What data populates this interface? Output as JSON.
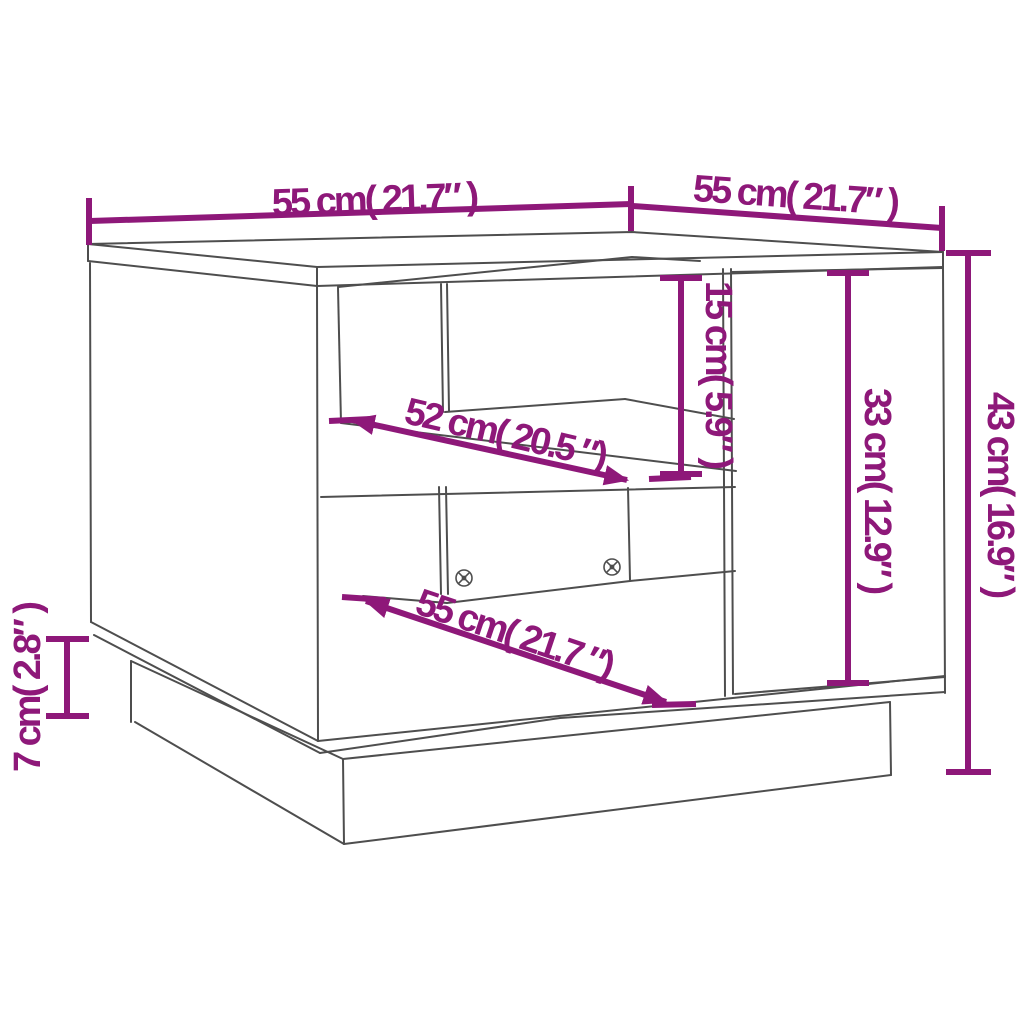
{
  "diagram": {
    "kind": "furniture-dimension-line-drawing",
    "subject": "coffee-table-with-shelves-and-base",
    "background": "#ffffff"
  },
  "colors": {
    "dimension": "#8E1879",
    "line": "#4e4e4e"
  },
  "dimensions": {
    "top_width": {
      "cm": 55,
      "inches": 21.7,
      "label": "55 cm( 21.7″ )"
    },
    "top_depth": {
      "cm": 55,
      "inches": 21.7,
      "label": "55 cm( 21.7″ )"
    },
    "height_total": {
      "cm": 43,
      "inches": 16.9,
      "label": "43 cm( 16.9″ )"
    },
    "door_height": {
      "cm": 33,
      "inches": 12.9,
      "label": "33 cm( 12.9″ )"
    },
    "shelf_clearance": {
      "cm": 15,
      "inches": 5.9,
      "label": "15 cm( 5.9″ )"
    },
    "base_height": {
      "cm": 7,
      "inches": 2.8,
      "label": "7 cm( 2.8″ )"
    },
    "shelf_depth": {
      "cm": 52,
      "inches": 20.5,
      "label": "52 cm( 20.5 ″)"
    },
    "inner_width": {
      "cm": 55,
      "inches": 21.7,
      "label": "55 cm( 21.7 ″)"
    }
  }
}
